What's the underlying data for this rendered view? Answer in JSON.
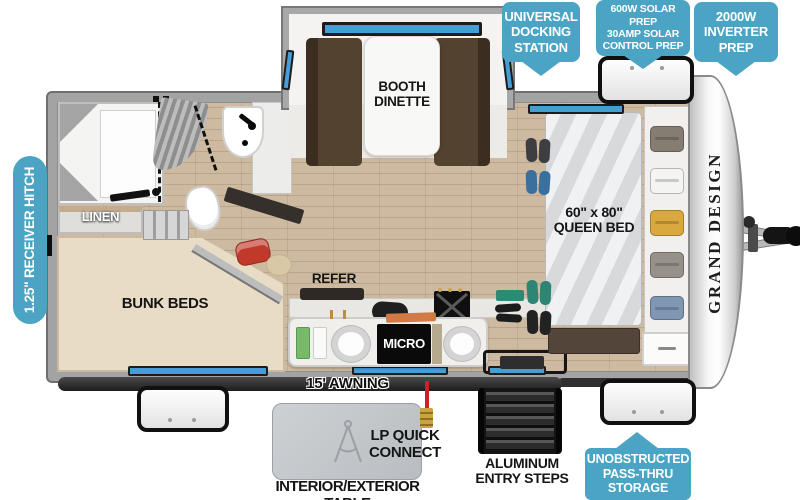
{
  "callouts": {
    "docking": "UNIVERSAL\nDOCKING\nSTATION",
    "solar": "600W SOLAR PREP\n30AMP SOLAR\nCONTROL PREP",
    "inverter": "2000W\nINVERTER\nPREP",
    "hitch": "1.25\" RECEIVER HITCH",
    "passthru": "UNOBSTRUCTED\nPASS-THRU\nSTORAGE"
  },
  "rooms": {
    "dinette": "BOOTH\nDINETTE",
    "linen": "LINEN",
    "bunks": "BUNK BEDS",
    "refer": "REFER",
    "micro": "MICRO",
    "queen": "60\" x 80\"\nQUEEN BED"
  },
  "exterior": {
    "awning": "15' AWNING",
    "lp": "LP QUICK\nCONNECT",
    "steps": "ALUMINUM\nENTRY STEPS",
    "table": "INTERIOR/EXTERIOR TABLE"
  },
  "brand": "GRAND DESIGN",
  "colors": {
    "callout_teal": "#4BA4C4",
    "window_blue": "#459FD6",
    "wood_floor": "#CDBAA0",
    "bunk_beige": "#E9DCC6",
    "bench_brown": "#53422F"
  }
}
